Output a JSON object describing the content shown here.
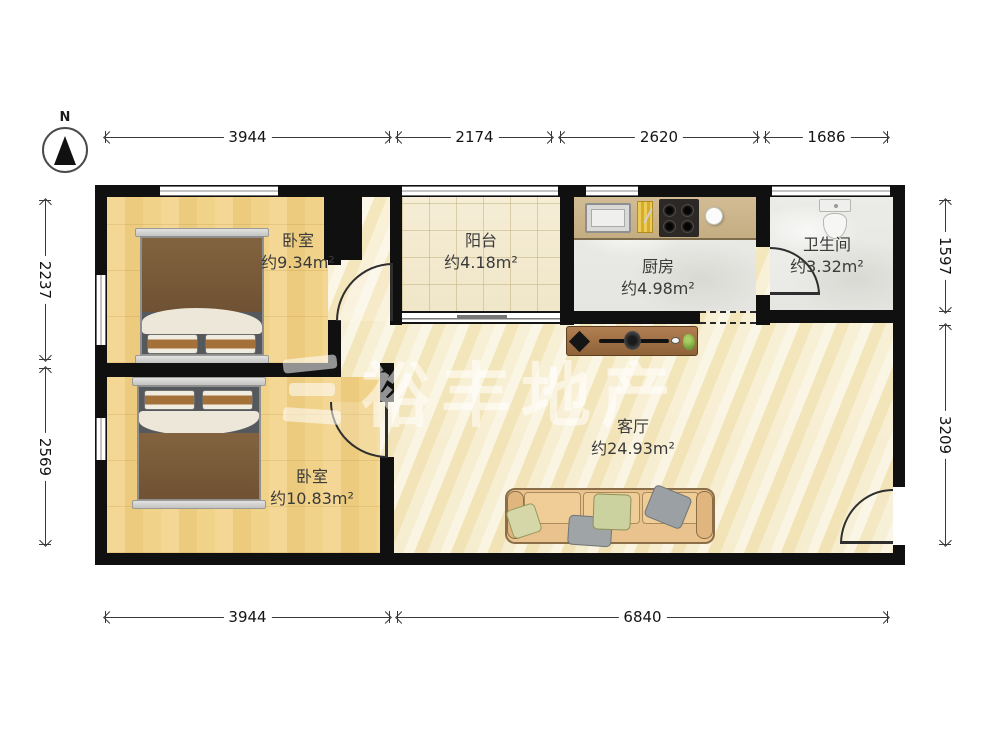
{
  "compass": {
    "label": "N"
  },
  "watermark": {
    "text": "裕丰地产"
  },
  "dimensions": {
    "top": [
      "3944",
      "2174",
      "2620",
      "1686"
    ],
    "bottom": [
      "3944",
      "6840"
    ],
    "left": [
      "2237",
      "2569"
    ],
    "right": [
      "1597",
      "3209"
    ]
  },
  "rooms": {
    "bedroom1": {
      "name": "卧室",
      "area": "约9.34m²"
    },
    "balcony": {
      "name": "阳台",
      "area": "约4.18m²"
    },
    "kitchen": {
      "name": "厨房",
      "area": "约4.98m²"
    },
    "bathroom": {
      "name": "卫生间",
      "area": "约3.32m²"
    },
    "bedroom2": {
      "name": "卧室",
      "area": "约10.83m²"
    },
    "living": {
      "name": "客厅",
      "area": "约24.93m²"
    }
  },
  "colors": {
    "wall": "#101010",
    "woodFloor": "#f0cf87",
    "livingFloor": "#f6ebcb",
    "tileFloor": "#f2e9cf",
    "grayFloor": "#e9e9e5",
    "counter": "#cdb691",
    "bedBlanket": "#7b5b38",
    "sofa": "#eac28d",
    "watermark": "rgba(255,255,255,0.55)"
  }
}
